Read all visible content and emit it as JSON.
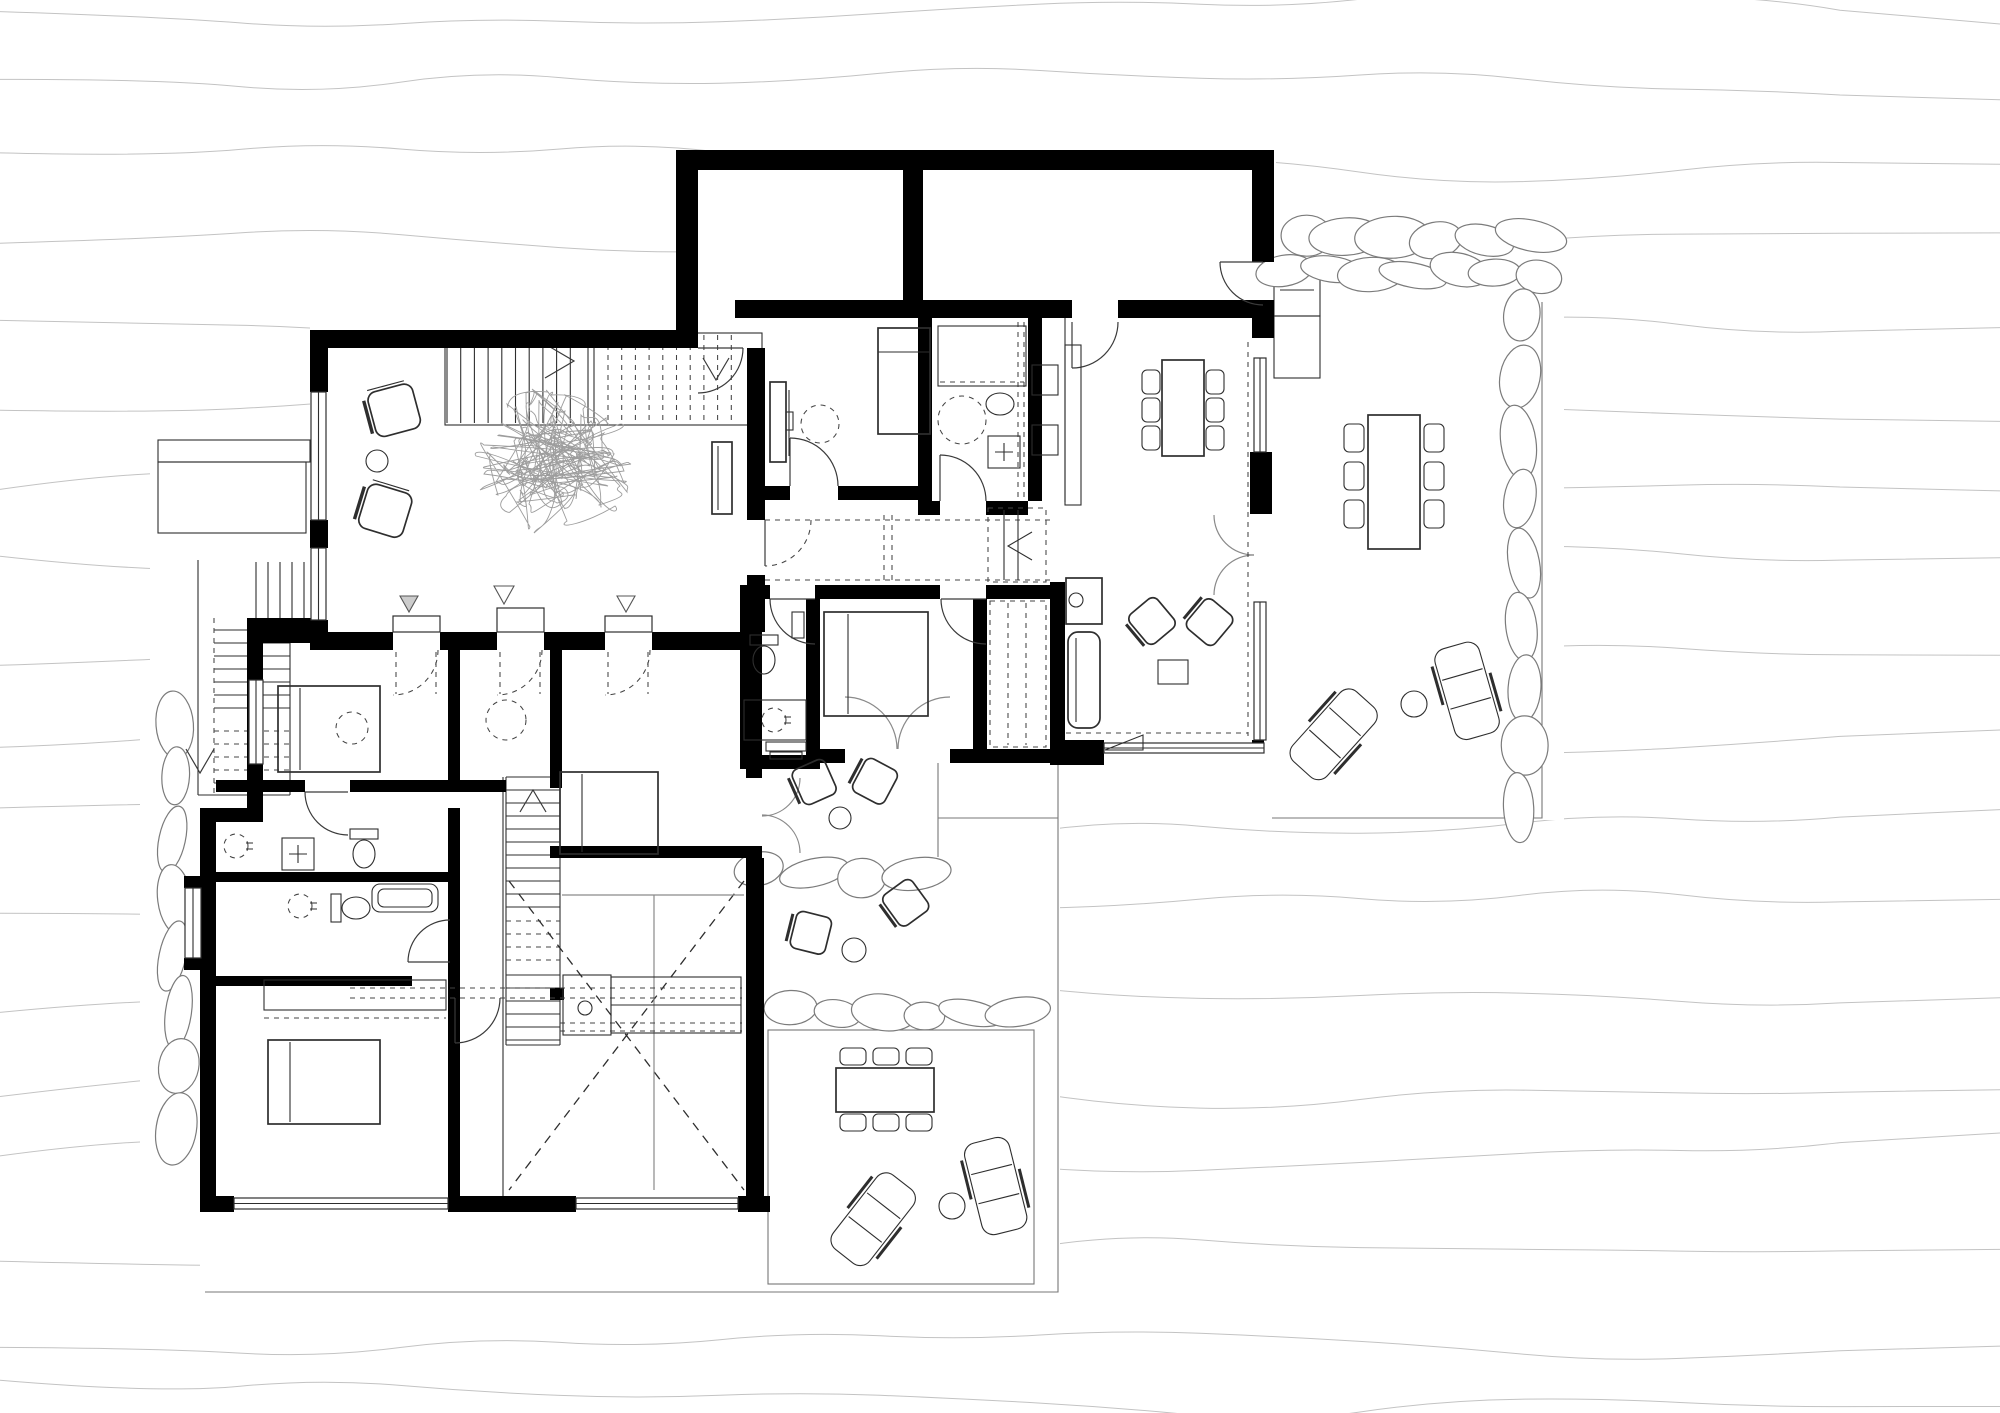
{
  "document": {
    "kind": "architectural floor plan drawing",
    "visible_text": [],
    "canvas": {
      "width": 2000,
      "height": 1413
    },
    "palette": {
      "walls": "#000000",
      "linework": "#2e2e2e",
      "secondary_linework": "#8a8a8a",
      "terrain_contours": "#c3c3c3",
      "stone_outline": "#7b7b7b",
      "paper": "#ffffff"
    }
  },
  "site": {
    "terrain": "sloping site drawn with wavy horizontal contour lines that stop at buildings and terraces",
    "stone_walls": [
      "double row along north edge of east terrace",
      "column along east edge of east terrace",
      "short row between patio-1 and patio-2",
      "row between patio-2 and south terrace",
      "column along west garden edge"
    ],
    "outdoor_areas": [
      {
        "name": "east-terrace",
        "furniture": [
          "outdoor dining table with six chairs",
          "two sun loungers",
          "round side table"
        ],
        "extras": [
          "two entry step platforms"
        ]
      },
      {
        "name": "south-terrace",
        "furniture": [
          "outdoor dining table with six chairs",
          "two sun loungers",
          "round side table"
        ]
      },
      {
        "name": "patio-1",
        "furniture": [
          "two armchairs",
          "round side table"
        ],
        "extras": [
          "small exterior steps"
        ]
      },
      {
        "name": "patio-2",
        "furniture": [
          "two armchairs",
          "round side table"
        ]
      },
      {
        "name": "west-exterior-stair",
        "description": "L-shaped garden stair running down along the west side, arrow pointing down"
      }
    ]
  },
  "building": {
    "upper_level_rooms": [
      {
        "name": "storage-room-west",
        "furniture": []
      },
      {
        "name": "storage-room-east",
        "furniture": [],
        "doors": [
          "to east terrace",
          "to dining room"
        ]
      },
      {
        "name": "living-room",
        "furniture": [
          "straight staircase with arrow",
          "two armchairs",
          "round side table",
          "large indoor plant",
          "sideboard"
        ],
        "windows": 2,
        "door_openings_south": 3
      },
      {
        "name": "study-bedroom",
        "furniture": [
          "desk",
          "chair (dashed circle)",
          "single bed"
        ]
      },
      {
        "name": "bathroom-main",
        "furniture": [
          "shower",
          "washbasin",
          "wc",
          "washing machine",
          "dashed clearance circle"
        ]
      },
      {
        "name": "entry-vestibule",
        "furniture": [
          "two wall cabinets",
          "built-in wardrobe with arrow marker"
        ]
      },
      {
        "name": "hallway",
        "features": [
          "dashed ceiling lines",
          "sliding door tracks"
        ]
      },
      {
        "name": "dining-kitchen-living",
        "furniture": [
          "kitchen counter",
          "island with sink",
          "dining table with six chairs",
          "sofa",
          "two easy chairs",
          "coffee table"
        ],
        "glazing": [
          "east wall",
          "south wall",
          "double french door to terrace"
        ]
      },
      {
        "name": "wc-guest",
        "furniture": [
          "wc",
          "tall cabinet",
          "washbasin counter"
        ]
      },
      {
        "name": "master-bedroom",
        "furniture": [
          "double bed"
        ],
        "doors": [
          "french door to patio-1"
        ]
      },
      {
        "name": "walk-in-closet",
        "features": [
          "dashed wardrobe outline"
        ]
      }
    ],
    "lower_wing_rooms": [
      {
        "name": "bedroom-1",
        "furniture": [
          "double bed",
          "dashed clearance circle"
        ],
        "windows": 1
      },
      {
        "name": "bedroom-2",
        "furniture": [
          "dashed clearance circle"
        ]
      },
      {
        "name": "bedroom-3",
        "furniture": [
          "bed"
        ],
        "doors": [
          "french door to patio-1"
        ]
      },
      {
        "name": "bathroom-upper",
        "furniture": [
          "washbasin",
          "washing machine",
          "wc"
        ]
      },
      {
        "name": "bathroom-lower",
        "furniture": [
          "washbasin",
          "wc",
          "bathtub"
        ],
        "windows": [
          "west bay window"
        ]
      },
      {
        "name": "bedroom-4",
        "furniture": [
          "double bed",
          "long low wardrobe"
        ],
        "windows": [
          "long south window"
        ]
      },
      {
        "name": "stairwell",
        "description": "straight flight down with landing and up-arrow"
      },
      {
        "name": "double-height-void",
        "marker": "large dashed X",
        "extras": [
          "kitchenette block with sink",
          "counter with dashed front lines"
        ]
      }
    ]
  },
  "furniture_inventory": {
    "beds": 5,
    "dining_tables": 3,
    "sun_loungers": 4,
    "armchairs_outdoor": 4,
    "armchairs_indoor": 4,
    "sofas": 1,
    "desks": 1,
    "plants": 1,
    "staircases": 4,
    "round_side_tables": 5,
    "wc": 4,
    "washbasins": 5,
    "bathtubs": 1,
    "showers": 1,
    "washing_machines": 2
  }
}
